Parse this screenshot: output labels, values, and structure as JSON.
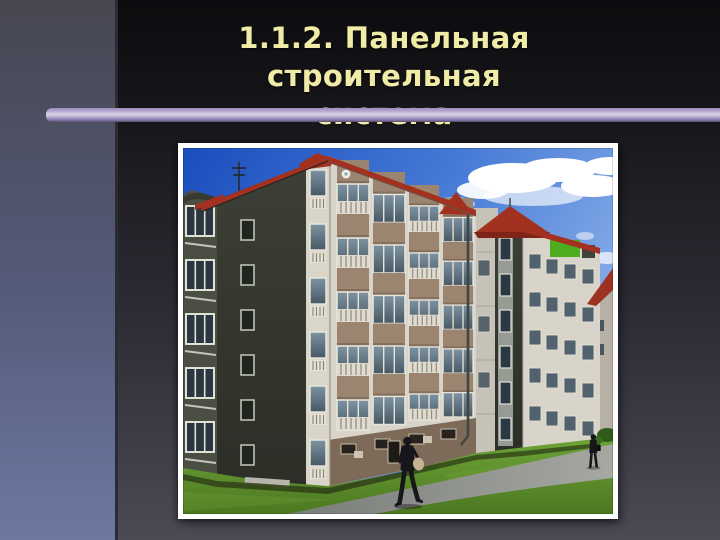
{
  "slide": {
    "title": {
      "line1": "1.1.2. Панельная строительная",
      "line2": "система",
      "color": "#f0eba6"
    },
    "divider": {
      "color_top": "#9c8cbc",
      "color_light": "#d8cfe6",
      "color_bottom": "#564e6b"
    },
    "background": {
      "left_band_top": "#474751",
      "left_band_bottom": "#6d79a1",
      "main_top": "#0c0c0f",
      "main_bottom": "#4b4a55"
    }
  },
  "photo": {
    "alt": "Five-storey prefabricated panel apartment building with glazed balconies, red roof trim, green lawn, footpath and two pedestrians",
    "frame_color": "#ffffff",
    "colors": {
      "sky_top": "#1b4dbd",
      "sky_mid": "#4579d6",
      "sky_low": "#8fb4e9",
      "cloud": "#ffffff",
      "dark_wall": "#3d4036",
      "facade": "#d8d4c9",
      "panel_tan": "#9b8571",
      "window_glass": "#465864",
      "roof_red": "#a23120",
      "green_panel": "#4cae1e",
      "ground_floor": "#7d6a58",
      "grass_light": "#6ea538",
      "grass_dark": "#4c7720",
      "path_near": "#787c78",
      "path_far": "#a6a8a2",
      "pedestrian": "#17171b",
      "bag": "#c3b393"
    }
  }
}
